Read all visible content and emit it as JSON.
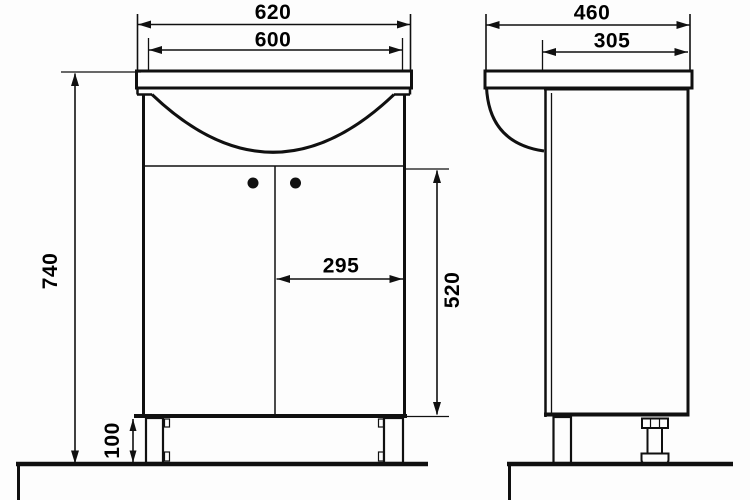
{
  "drawing": {
    "type": "technical-drawing",
    "subject": "bathroom vanity unit with basin, front and side elevation views",
    "units": "mm",
    "colors": {
      "line": "#101010",
      "background": "#fdfdfd",
      "text": "#000000"
    },
    "dimensions": {
      "front_overall_width": "620",
      "front_cabinet_width": "600",
      "side_overall_depth": "460",
      "side_cabinet_depth": "305",
      "overall_height": "740",
      "door_width": "295",
      "door_height": "520",
      "plinth_height": "100"
    }
  }
}
